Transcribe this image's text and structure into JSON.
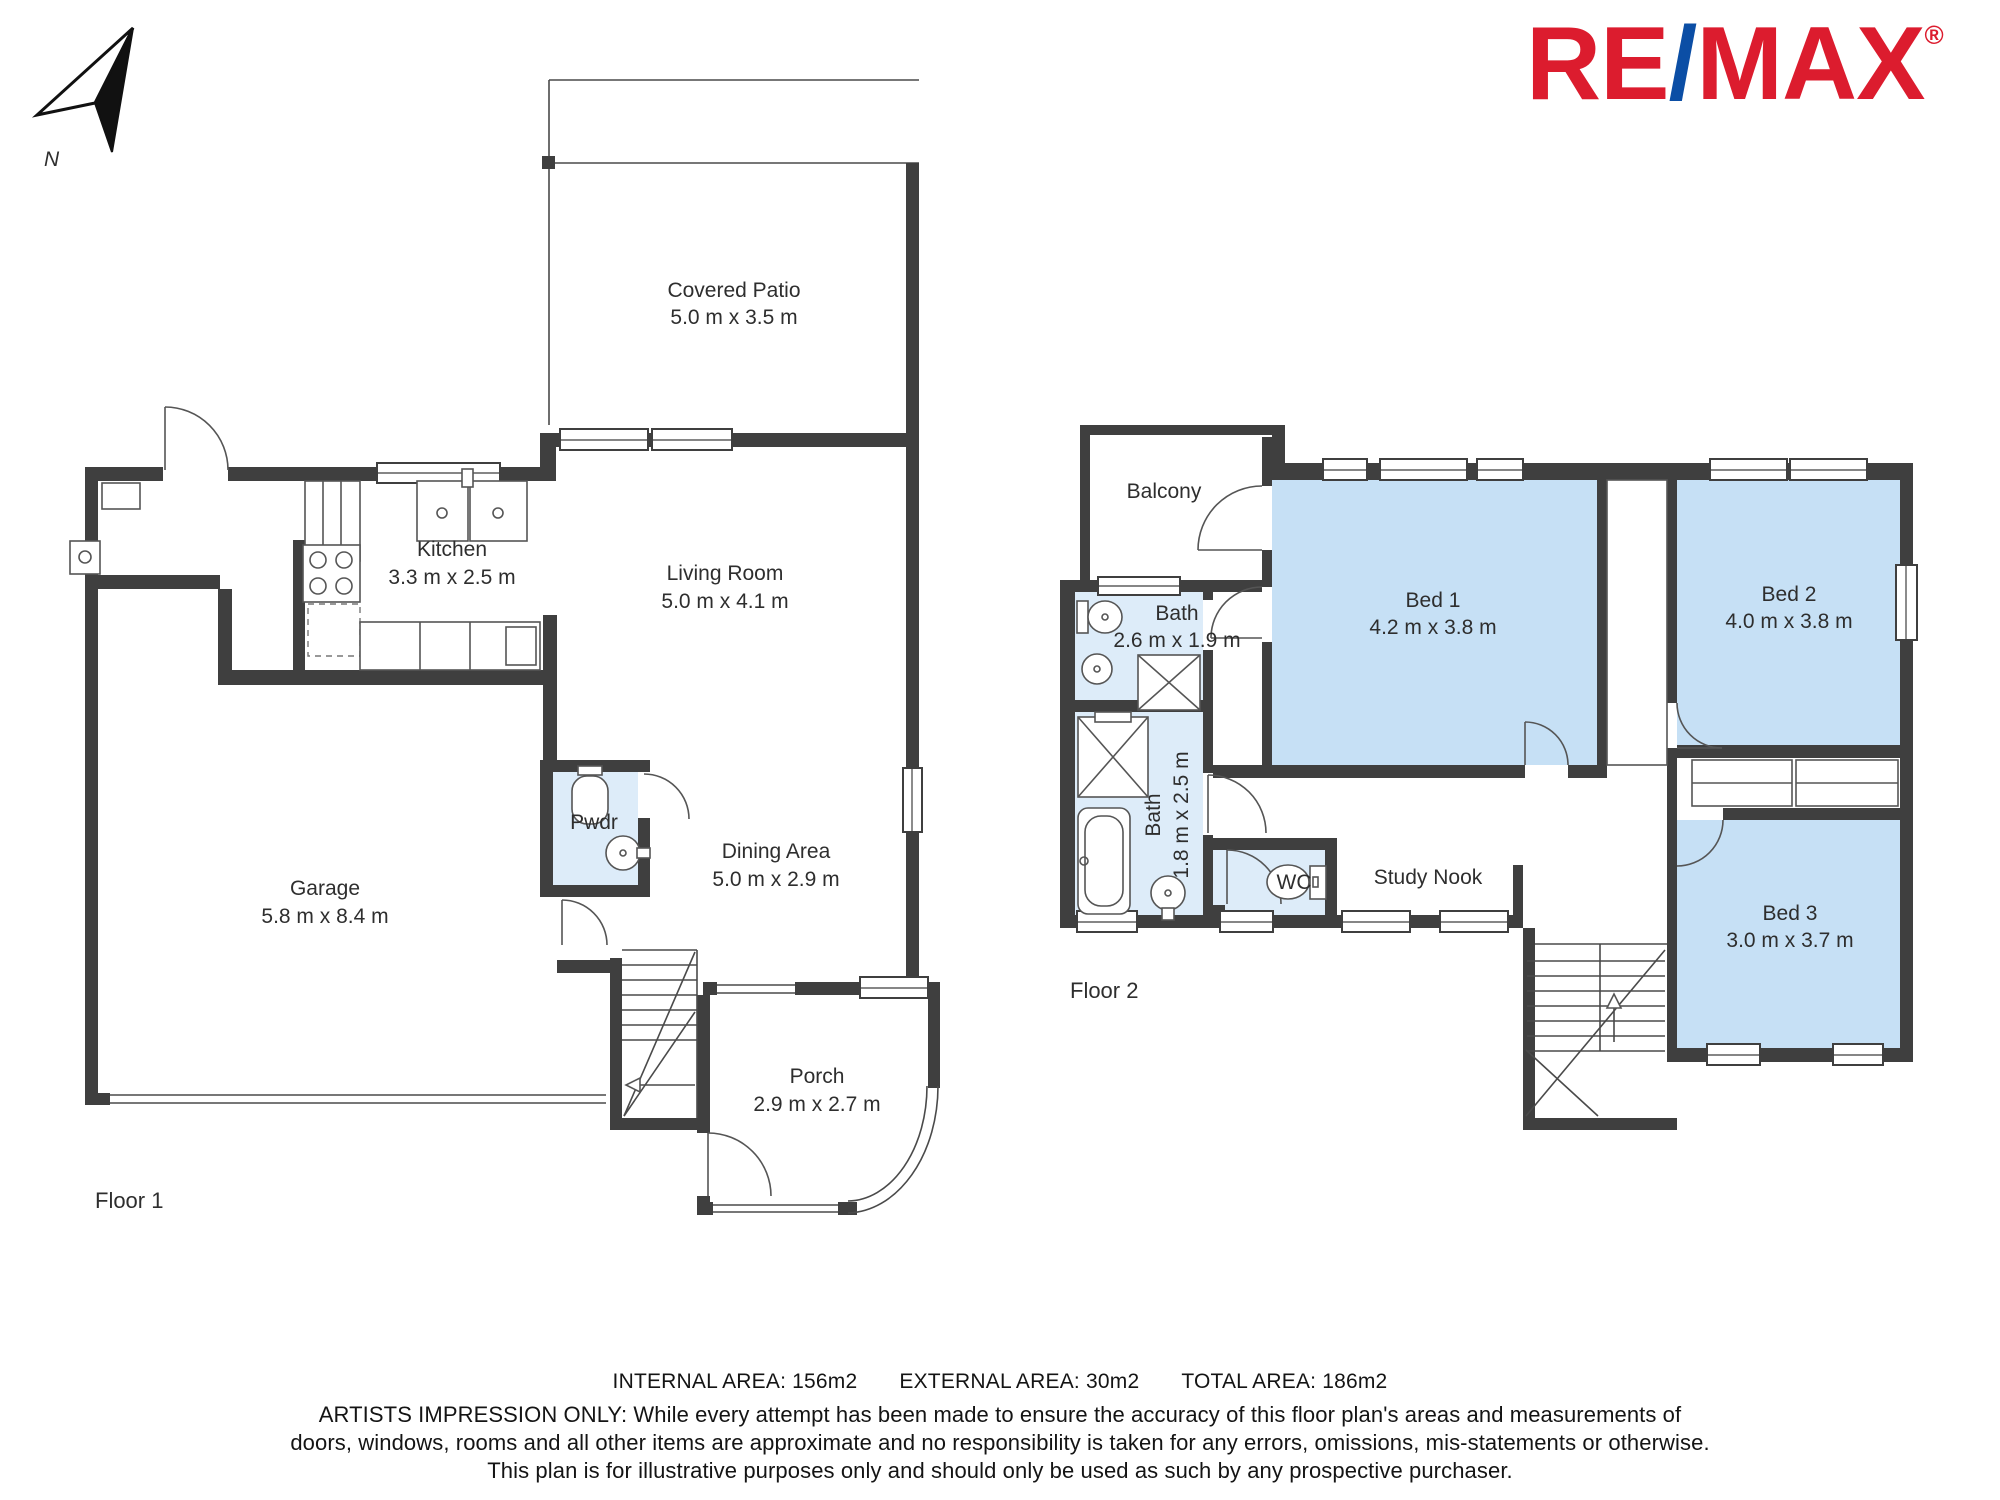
{
  "compass": {
    "letter": "N"
  },
  "logo": {
    "re": "RE",
    "slash": "/",
    "max": "MAX",
    "registered": "®",
    "red": "#dc1c2e",
    "blue": "#0b4ea5"
  },
  "colors": {
    "wall": "#3f3f3f",
    "bed_fill": "#c6e0f5",
    "bath_fill": "#ddecf9"
  },
  "floor1": {
    "label": "Floor 1",
    "rooms": {
      "covered_patio": {
        "name": "Covered Patio",
        "dims": "5.0 m x 3.5 m"
      },
      "kitchen": {
        "name": "Kitchen",
        "dims": "3.3 m x 2.5 m"
      },
      "living_room": {
        "name": "Living Room",
        "dims": "5.0 m x 4.1 m"
      },
      "pwdr": {
        "name": "Pwdr"
      },
      "dining_area": {
        "name": "Dining Area",
        "dims": "5.0 m x 2.9 m"
      },
      "garage": {
        "name": "Garage",
        "dims": "5.8 m x 8.4 m"
      },
      "porch": {
        "name": "Porch",
        "dims": "2.9 m x 2.7 m"
      }
    }
  },
  "floor2": {
    "label": "Floor 2",
    "rooms": {
      "balcony": {
        "name": "Balcony"
      },
      "bath_upper": {
        "name": "Bath",
        "dims": "2.6 m x 1.9 m"
      },
      "bed1": {
        "name": "Bed 1",
        "dims": "4.2 m x 3.8 m"
      },
      "bed2": {
        "name": "Bed 2",
        "dims": "4.0 m x 3.8 m"
      },
      "bath_lower": {
        "name": "Bath",
        "dims": "1.8 m x 2.5 m"
      },
      "wc": {
        "name": "WC"
      },
      "study_nook": {
        "name": "Study Nook"
      },
      "bed3": {
        "name": "Bed 3",
        "dims": "3.0 m x 3.7 m"
      }
    }
  },
  "footer": {
    "internal": "INTERNAL AREA: 156m2",
    "external": "EXTERNAL AREA: 30m2",
    "total": "TOTAL AREA: 186m2",
    "disclaimer_line1": "ARTISTS IMPRESSION ONLY: While every attempt has been made to ensure the accuracy of this floor plan's areas and measurements of",
    "disclaimer_line2": "doors, windows, rooms and all other items are approximate and no responsibility is taken for any errors, omissions, mis-statements or otherwise.",
    "disclaimer_line3": "This plan is for illustrative purposes only and should only be used as such by any prospective purchaser."
  }
}
